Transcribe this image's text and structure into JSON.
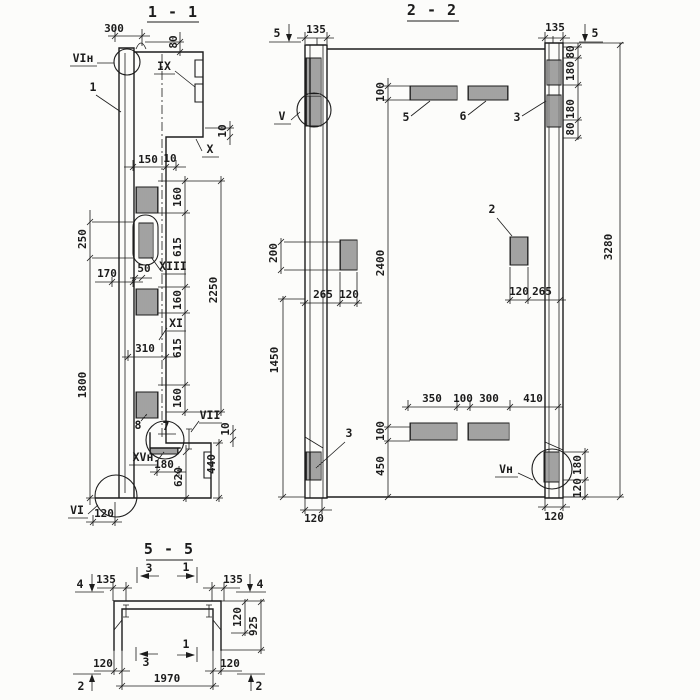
{
  "colors": {
    "ink": "#1c1c1c",
    "paper": "#fcfcfa"
  },
  "s11": {
    "title": "1 - 1",
    "labels": {
      "vi_top": "VIн",
      "item1": "1",
      "ix": "IX",
      "x": "X",
      "xiii": "XIII",
      "xi": "XI",
      "item8": "8",
      "item7": "7",
      "vii": "VII",
      "xv": "XVн",
      "vi_bottom": "VI"
    },
    "dims": {
      "top300": "300",
      "top80": "80",
      "step10": "10",
      "n150": "150",
      "n10": "10",
      "seg160a": "160",
      "seg615a": "615",
      "seg160b": "160",
      "seg615b": "615",
      "seg160c": "160",
      "total2250": "2250",
      "left250": "250",
      "left170": "170",
      "n50": "50",
      "n310": "310",
      "left1800": "1800",
      "br10": "10",
      "br440": "440",
      "br180": "180",
      "br620": "620",
      "bot120": "120"
    }
  },
  "s22": {
    "title": "2 - 2",
    "cut5_left": "5",
    "cut5_right": "5",
    "labels": {
      "v": "V",
      "item5": "5",
      "item6": "6",
      "item3_top": "3",
      "item2": "2",
      "item3_bot": "3",
      "vn": "Vн"
    },
    "dims": {
      "l135": "135",
      "r135": "135",
      "top100": "100",
      "rc80a": "80",
      "rc180a": "180",
      "rc180b": "180",
      "rc80b": "80",
      "total3280": "3280",
      "l200": "200",
      "ls265": "265",
      "ls120": "120",
      "rs120": "120",
      "rs265": "265",
      "mid2400": "2400",
      "low100": "100",
      "low450": "450",
      "l1450": "1450",
      "b350": "350",
      "b100": "100",
      "b300": "300",
      "b410": "410",
      "br180": "180",
      "br120": "120",
      "bl120": "120",
      "brb120": "120"
    }
  },
  "s55": {
    "title": "5 - 5",
    "cut4_left": "4",
    "cut4_right": "4",
    "cut2_left": "2",
    "cut2_right": "2",
    "cut3_top": "3",
    "cut1_top": "1",
    "cut3_bot": "3",
    "cut1_bot": "1",
    "dims": {
      "l135": "135",
      "r135": "135",
      "t120": "120",
      "h925": "925",
      "bl120": "120",
      "br120": "120",
      "span1970": "1970"
    }
  }
}
